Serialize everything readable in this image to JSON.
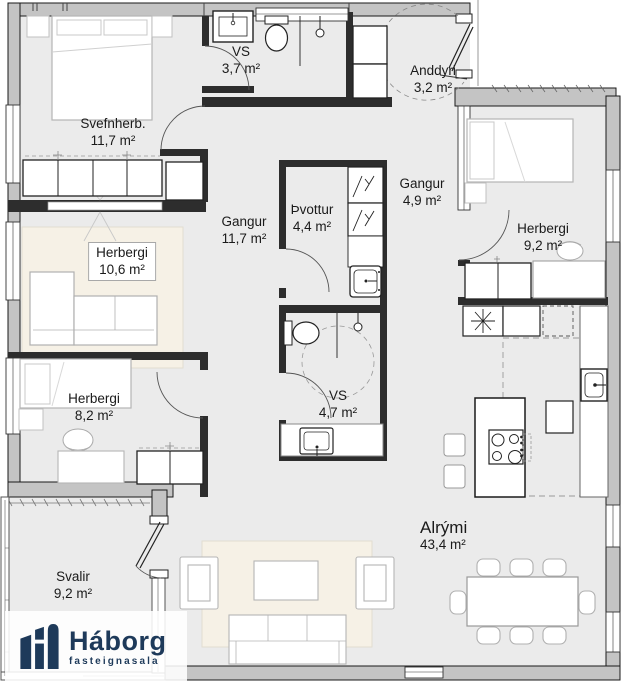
{
  "plan": {
    "rooms": [
      {
        "id": "svefnherb",
        "label": "Svefnherb.",
        "area": "11,7 m²"
      },
      {
        "id": "vs-upper",
        "label": "VS",
        "area": "3,7 m²"
      },
      {
        "id": "anddyri",
        "label": "Anddyri",
        "area": "3,2 m²"
      },
      {
        "id": "gangur-main",
        "label": "Gangur",
        "area": "11,7 m²"
      },
      {
        "id": "thvottur",
        "label": "Þvottur",
        "area": "4,4 m²"
      },
      {
        "id": "gangur-east",
        "label": "Gangur",
        "area": "4,9 m²"
      },
      {
        "id": "herbergi-east",
        "label": "Herbergi",
        "area": "9,2 m²"
      },
      {
        "id": "herbergi-west",
        "label": "Herbergi",
        "area": "10,6 m²"
      },
      {
        "id": "herbergi-southwest",
        "label": "Herbergi",
        "area": "8,2 m²"
      },
      {
        "id": "vs-lower",
        "label": "VS",
        "area": "4,7 m²"
      },
      {
        "id": "alrymi",
        "label": "Alrými",
        "area": "43,4 m²"
      },
      {
        "id": "svalir",
        "label": "Svalir",
        "area": "9,2 m²"
      }
    ]
  },
  "logo": {
    "brand": "Háborg",
    "tagline": "fasteignasala",
    "color": "#1e3a5a"
  },
  "palette": {
    "floor": "#ebebeb",
    "wall_fill": "#c4c4c4",
    "wall_stroke": "#1a1a1a",
    "partition": "#2d2d2d",
    "furniture_light": "#b5b5b5",
    "fixture_dark": "#222222",
    "rug": "#f6f1e6",
    "door_arc": "#555555",
    "dashed": "#999999"
  }
}
